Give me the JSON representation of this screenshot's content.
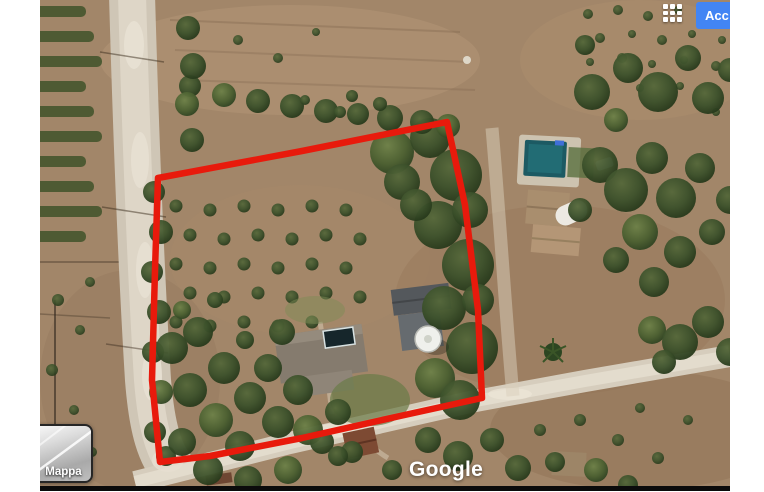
{
  "topbar": {
    "apps_icon": "google-apps-grid-icon",
    "signin_label": "Acc"
  },
  "map": {
    "watermark": "Google",
    "map_type_label": "Mappa",
    "parcel_outline": {
      "color": "#e81a0c",
      "stroke_width": 6.5,
      "points": "118,178 262,151 407,122 425,205 438,310 442,398 360,416 262,438 170,456 120,462 112,380 115,270"
    }
  },
  "colors": {
    "signin_blue": "#4285f4",
    "outline_red": "#e81a0c",
    "terrain_tan": "#a28669",
    "road_light": "#d8cfbf",
    "tree_green": "#3c512b",
    "pool_teal": "#1c5a63"
  }
}
